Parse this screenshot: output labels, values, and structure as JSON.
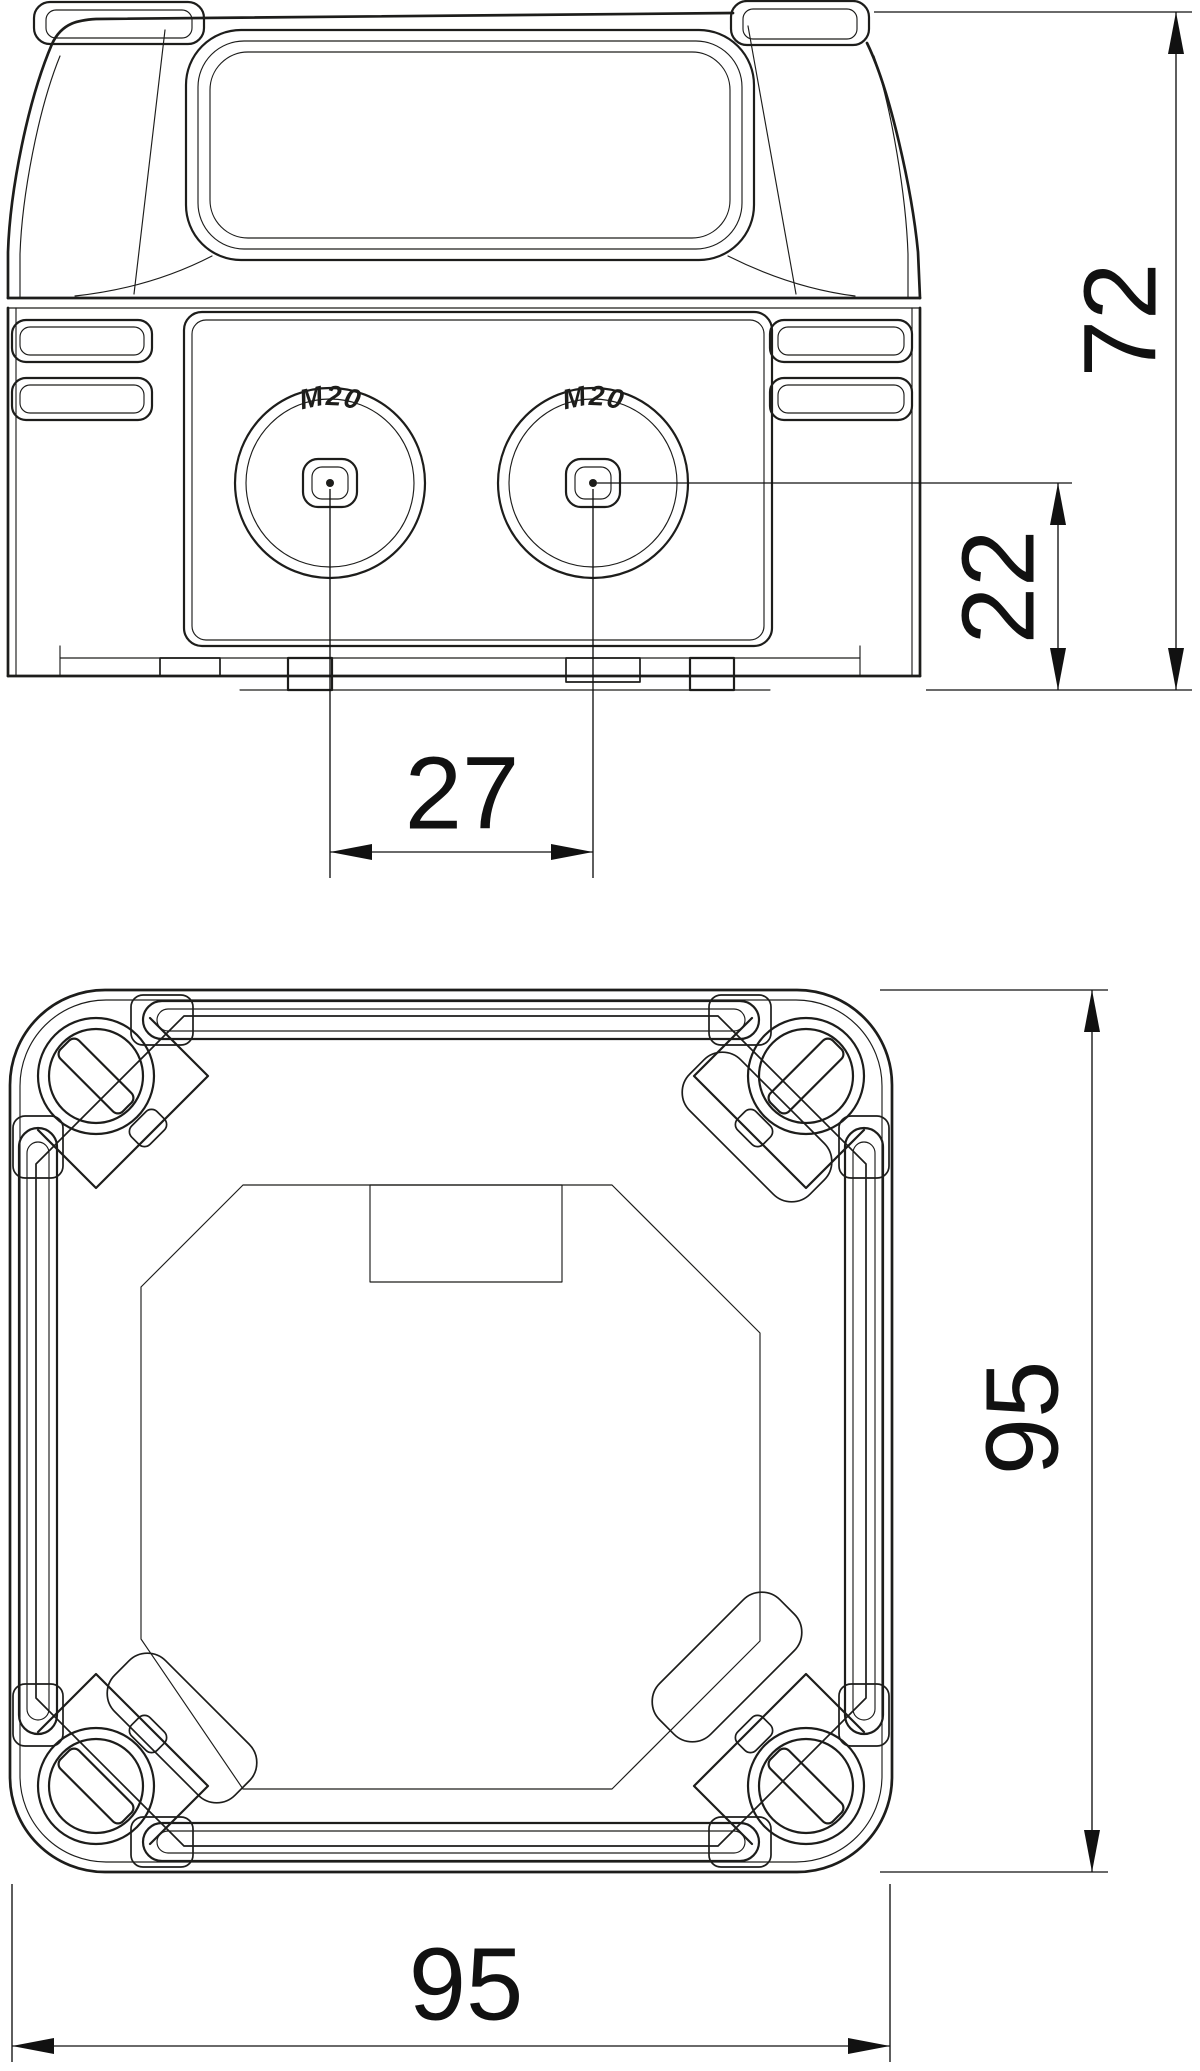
{
  "drawing": {
    "background": "#ffffff",
    "line_color": "#1d1d1b",
    "dimension_color": "#111111",
    "side_view": {
      "knockout_left_label": "M20",
      "knockout_right_label": "M20"
    },
    "dimensions": {
      "total_height": "72",
      "entry_center_height": "22",
      "entry_spacing": "27",
      "box_height": "95",
      "box_width": "95"
    }
  }
}
